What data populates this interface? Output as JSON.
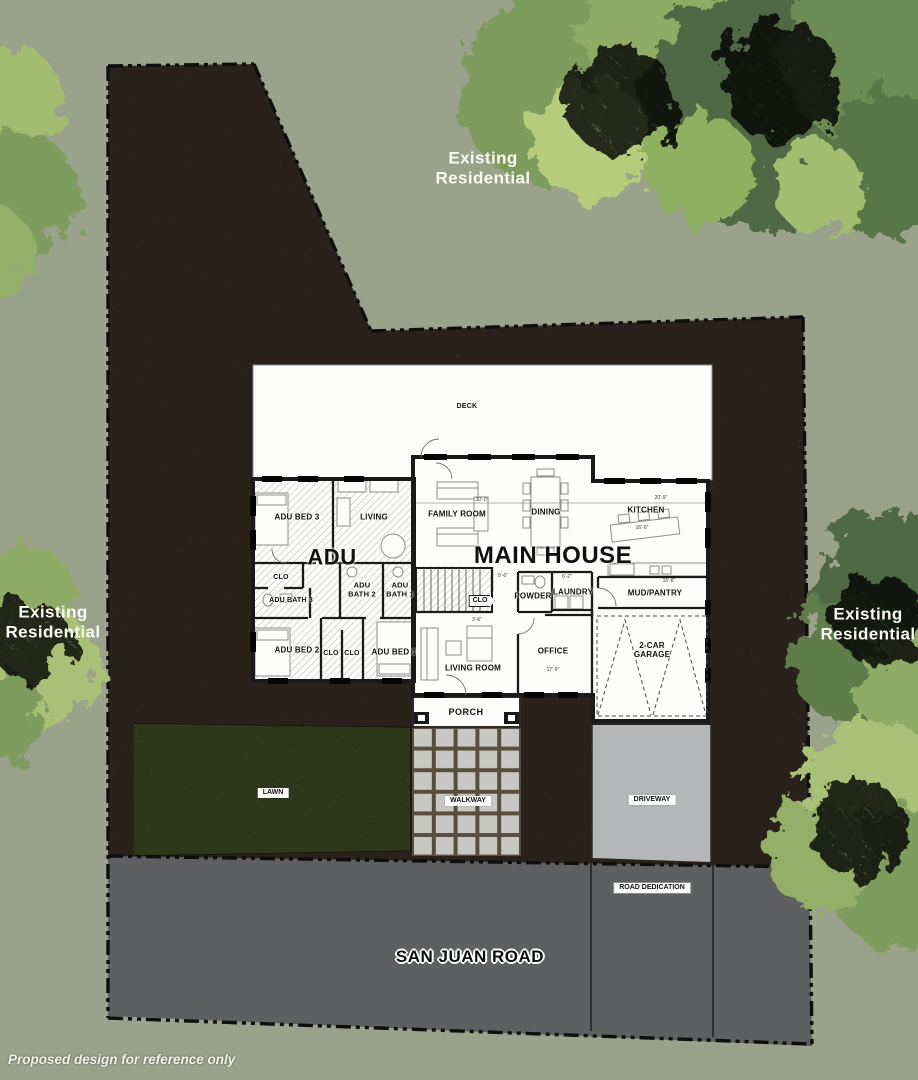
{
  "surroundings": {
    "existing_residential": "Existing Residential",
    "road_name": "SAN JUAN ROAD",
    "road_dedication": "ROAD DEDICATION",
    "disclaimer": "Proposed design for reference only"
  },
  "site_features": {
    "lawn": "LAWN",
    "walkway": "WALKWAY",
    "driveway": "DRIVEWAY",
    "porch": "PORCH",
    "deck": "DECK"
  },
  "adu": {
    "title": "ADU",
    "rooms": {
      "bed3": "ADU BED 3",
      "living": "LIVING",
      "closet": "CLO",
      "bath3": "ADU BATH 3",
      "bath2": "ADU BATH 2",
      "bath1": "ADU BATH 1",
      "bed2": "ADU BED 2",
      "bed1": "ADU BED 1"
    }
  },
  "main_house": {
    "title": "MAIN HOUSE",
    "rooms": {
      "family": "FAMILY ROOM",
      "dining": "DINING",
      "kitchen": "KITCHEN",
      "closet": "CLO",
      "powder": "POWDER",
      "laundry": "LAUNDRY",
      "mud_pantry": "MUD/PANTRY",
      "office": "OFFICE",
      "living_room": "LIVING ROOM",
      "garage": "2-CAR GARAGE"
    }
  },
  "dimensions": [
    {
      "text": "30'-0\"",
      "x": 482,
      "y": 500
    },
    {
      "text": "20'-9\"",
      "x": 661,
      "y": 498
    },
    {
      "text": "16'-0\"",
      "x": 642,
      "y": 528
    },
    {
      "text": "5'-6\"",
      "x": 503,
      "y": 576
    },
    {
      "text": "6'-2\"",
      "x": 567,
      "y": 577
    },
    {
      "text": "15'-8\"",
      "x": 669,
      "y": 581
    },
    {
      "text": "3'-6\"",
      "x": 477,
      "y": 620
    },
    {
      "text": "17'-9\"",
      "x": 553,
      "y": 670
    }
  ],
  "colors": {
    "background_sage": "#9BA28C",
    "dirt": "#7A6952",
    "road": "#5E5F60",
    "driveway": "#B5B6B8",
    "lawn": "#8DA34D",
    "walkway_tile": "#C8C8C2",
    "tree_light": "#B5CC7D",
    "tree_mid": "#7F9C5E",
    "tree_dark": "#506944",
    "wall": "#1A1A1A",
    "floor": "#FDFDFC"
  }
}
